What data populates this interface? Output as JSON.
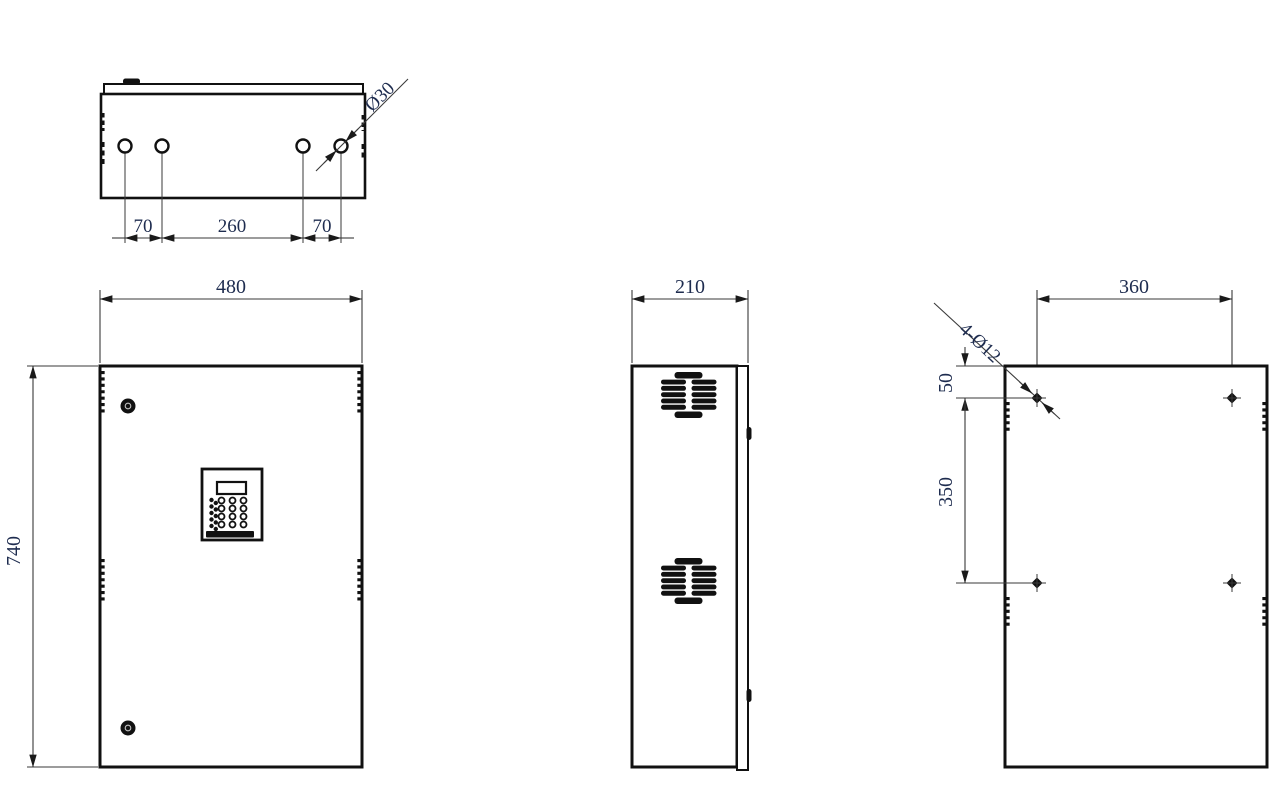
{
  "drawing": {
    "type": "technical-dimension-drawing",
    "subject": "control-cabinet-enclosure",
    "colors": {
      "outline": "#111111",
      "dimension_line": "#3a3a3a",
      "dimension_text": "#1e2c4f",
      "background": "#ffffff"
    },
    "views": {
      "top": {
        "hole_pitch_left": "70",
        "hole_pitch_center": "260",
        "hole_pitch_right": "70",
        "hole_diameter_note": "Ø30",
        "hole_count": 4
      },
      "front": {
        "width": "480",
        "height": "740"
      },
      "side": {
        "depth": "210"
      },
      "rear": {
        "hole_span_horizontal": "360",
        "hole_offset_top": "50",
        "hole_row_spacing": "350",
        "mounting_hole_note": "4-Ø12",
        "hole_count": 4
      }
    }
  }
}
